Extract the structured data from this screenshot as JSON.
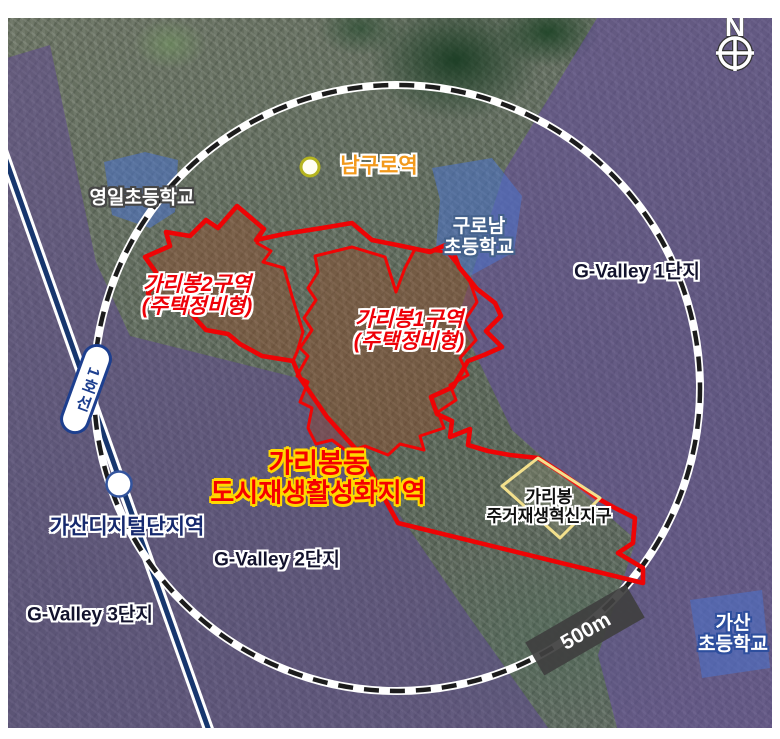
{
  "compass": {
    "north": "N"
  },
  "metro": {
    "line_badge": "1호선",
    "stations": {
      "namguro": "남구로역",
      "gasan_digital": "가산디지털단지역"
    }
  },
  "schools": {
    "yeongil": "영일초등학교",
    "guronam_line1": "구로남",
    "guronam_line2": "초등학교",
    "gasan_line1": "가산",
    "gasan_line2": "초등학교"
  },
  "gvalley": {
    "complex1": "G-Valley 1단지",
    "complex2": "G-Valley 2단지",
    "complex3": "G-Valley 3단지"
  },
  "zones": {
    "zone2_line1": "가리봉2구역",
    "zone2_line2": "(주택정비형)",
    "zone1_line1": "가리봉1구역",
    "zone1_line2": "(주택정비형)",
    "innovation_line1": "가리봉",
    "innovation_line2": "주거재생혁신지구"
  },
  "title": {
    "line1": "가리봉동",
    "line2": "도시재생활성화지역"
  },
  "scale_bar": {
    "label": "500m"
  },
  "colors": {
    "boundary_red": "#ee0405",
    "zone_label_red": "#ee0008",
    "title_red": "#f50000",
    "title_outline_yellow": "#ffd800",
    "metro_line_navy": "#17366e",
    "purple_overlay": "#684aa4",
    "school_patch_blue": "#4b73cd",
    "innovation_outline_yellow": "#f3e08c",
    "scale_bar_bg": "#3f3f3f",
    "namguro_orange": "#f2991c",
    "radius_circle_dash": "#1c1c1c"
  }
}
